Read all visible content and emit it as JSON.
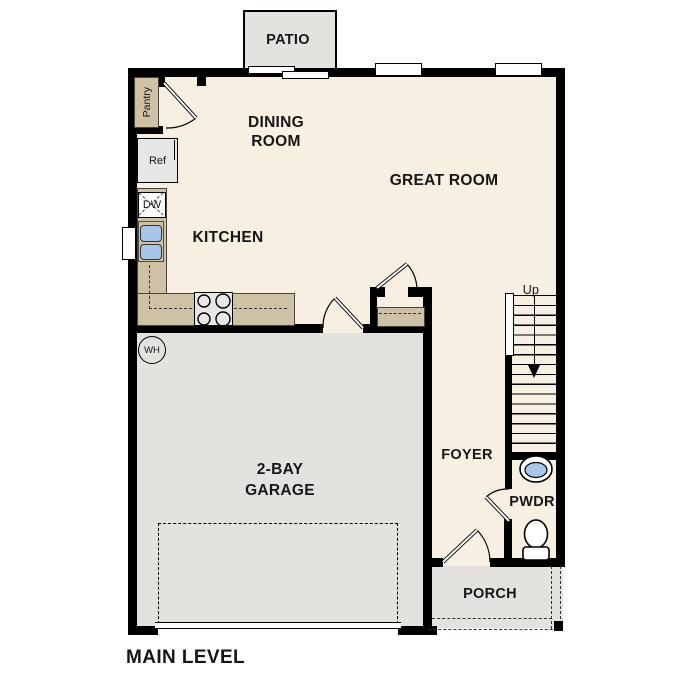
{
  "plan": {
    "level_label": "MAIN LEVEL",
    "rooms": {
      "patio": {
        "label": "PATIO"
      },
      "dining_room": {
        "label": "DINING ROOM"
      },
      "great_room": {
        "label": "GREAT ROOM"
      },
      "kitchen": {
        "label": "KITCHEN"
      },
      "garage": {
        "label": "2-BAY GARAGE"
      },
      "foyer": {
        "label": "FOYER"
      },
      "powder_room": {
        "label": "PWDR"
      },
      "porch": {
        "label": "PORCH"
      }
    },
    "fixtures": {
      "pantry": {
        "label": "Pantry"
      },
      "refrigerator": {
        "label": "Ref"
      },
      "dishwasher": {
        "label": "DW"
      },
      "water_heater": {
        "label": "WH"
      },
      "stairs": {
        "direction_label": "Up"
      }
    },
    "colors": {
      "background": "#ffffff",
      "floor": "#f6efe2",
      "garage_floor": "#e3e2df",
      "counter": "#cfc1a5",
      "sink": "#a8c7e8",
      "wall": "#000000"
    }
  }
}
